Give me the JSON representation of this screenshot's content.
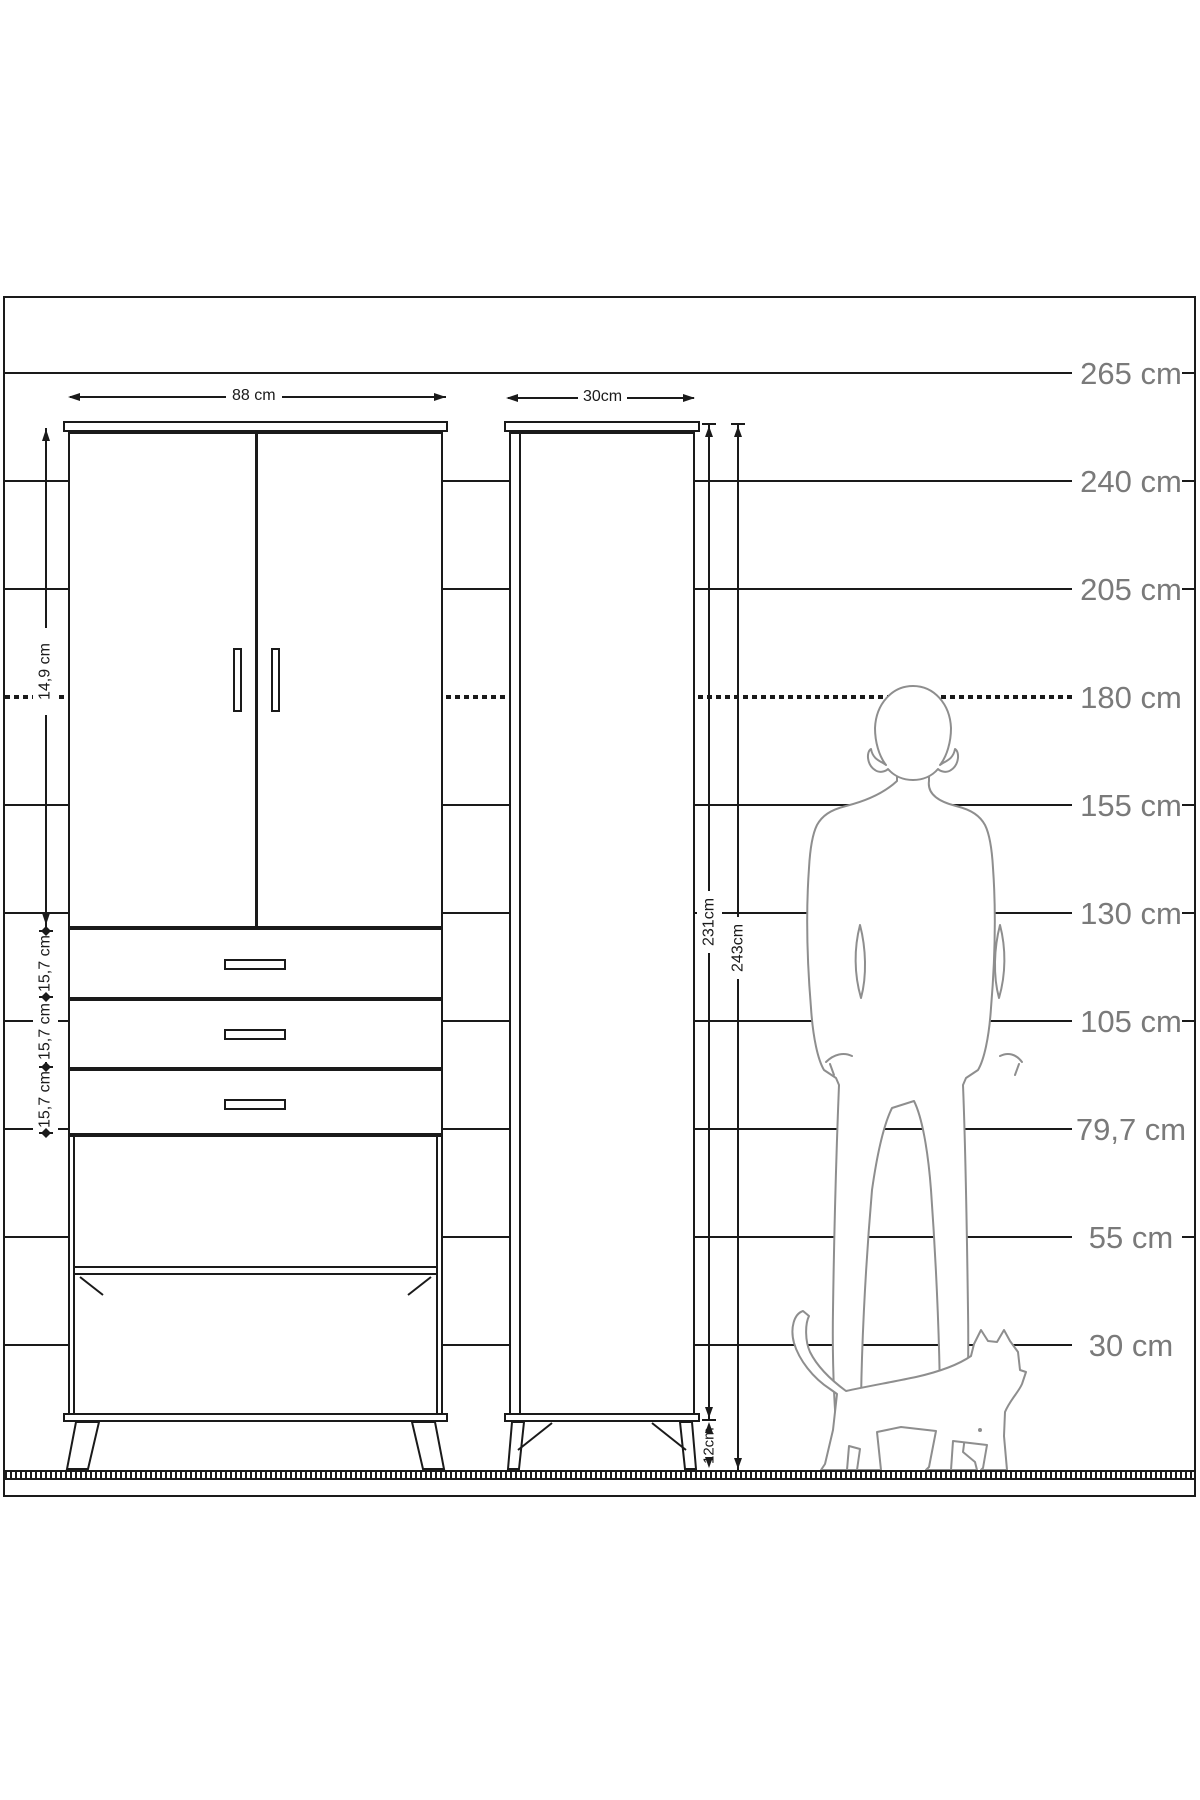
{
  "scale": {
    "items": [
      {
        "label": "265 cm"
      },
      {
        "label": "240 cm"
      },
      {
        "label": "205 cm"
      },
      {
        "label": "180 cm"
      },
      {
        "label": "155 cm"
      },
      {
        "label": "130 cm"
      },
      {
        "label": "105 cm"
      },
      {
        "label": "79,7 cm"
      },
      {
        "label": "55 cm"
      },
      {
        "label": "30 cm"
      }
    ]
  },
  "wardrobe": {
    "width_label": "88 cm",
    "upper_section_label": "14,9 cm",
    "drawer_labels": [
      "15,7 cm",
      "15,7 cm",
      "15,7 cm"
    ]
  },
  "tall_cabinet": {
    "width_label": "30cm",
    "body_height_label": "231cm",
    "total_height_label": "243cm",
    "leg_height_label": "12cm"
  },
  "colors": {
    "line": "#1a1a1a",
    "silhouette": "#8e8e8e",
    "scale_label": "#7a7a7a",
    "background": "#ffffff"
  }
}
